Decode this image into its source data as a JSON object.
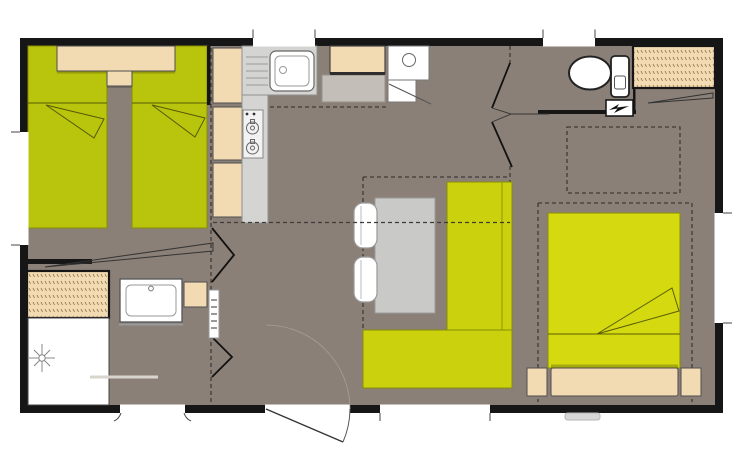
{
  "title": "Mobile home floor plan",
  "colors": {
    "page_bg": "#ffffff",
    "wall": "#161616",
    "floor": "#8b8078",
    "twin_bed_green": "#b9c40d",
    "double_bed_green": "#d5d90f",
    "sofa_green": "#cbd20d",
    "green_outline": "#878d07",
    "fold_line": "#565a06",
    "furniture_beige": "#f2dab3",
    "furniture_outline": "#4f4f4f",
    "counter_gray": "#d4d4d2",
    "counter_outline": "#8f8f8d",
    "appliance_gray": "#c3beb7",
    "table_gray": "#c9c9c7",
    "fixture_white": "#ffffff",
    "fixture_outline": "#222222",
    "dash_line": "#3f3b37",
    "step_gray": "#d7d7d7",
    "towel_rail_gray": "#d8d4ce",
    "wardrobe_texture": "#8a6a3a",
    "shadow": "rgba(0,0,0,0.2)"
  }
}
